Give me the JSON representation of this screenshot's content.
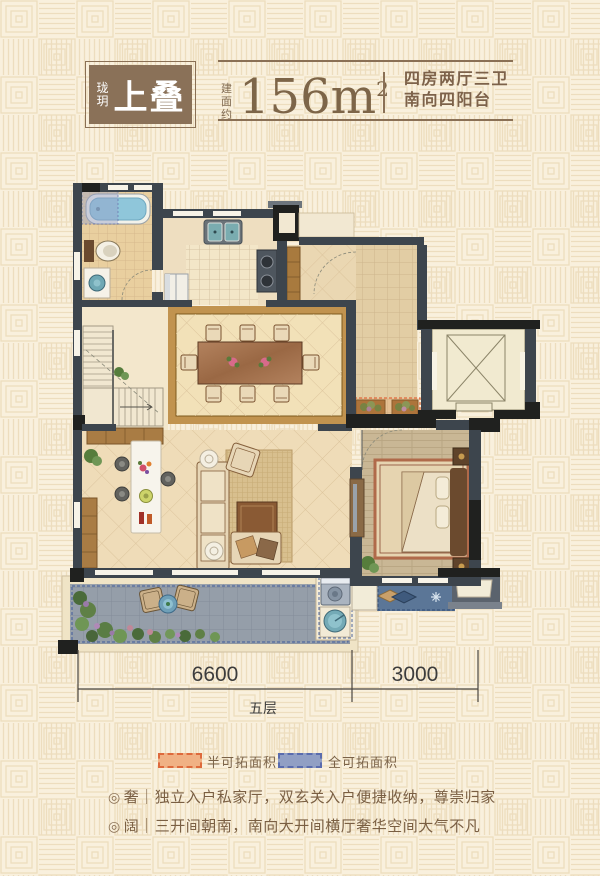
{
  "header": {
    "logo": {
      "small": "珑玥",
      "large": "上叠",
      "box_color": "#8a7158"
    },
    "area": {
      "prefix": "建面约",
      "value": "156m",
      "sup": "2"
    },
    "desc": {
      "line1": "四房两厅三卫",
      "line2": "南向四阳台"
    }
  },
  "dimensions": {
    "left": "6600",
    "right": "3000",
    "floor": "五层"
  },
  "legend": {
    "items": [
      {
        "label": "半可拓面积",
        "fill": "#f0b184",
        "stroke": "#de6a3c"
      },
      {
        "label": "全可拓面积",
        "fill": "#919fc4",
        "stroke": "#5a6cae"
      }
    ]
  },
  "features": {
    "items": [
      {
        "bullet": "◎",
        "text": "奢｜独立入户私家厅，双玄关入户便捷收纳，尊崇归家"
      },
      {
        "bullet": "◎",
        "text": "阔｜三开间朝南，南向大开间横厅奢华空间大气不凡"
      }
    ]
  },
  "palette": {
    "background": "#f9f0dd",
    "pattern_line": "#edddbe",
    "wall": "#3d454d",
    "wall_black": "#20211f",
    "floor_tan": "#f1dfb8",
    "terrace_gray": "#9aa2ab",
    "balcony_blue": "#5b7697",
    "accent_brown": "#8a7055"
  }
}
